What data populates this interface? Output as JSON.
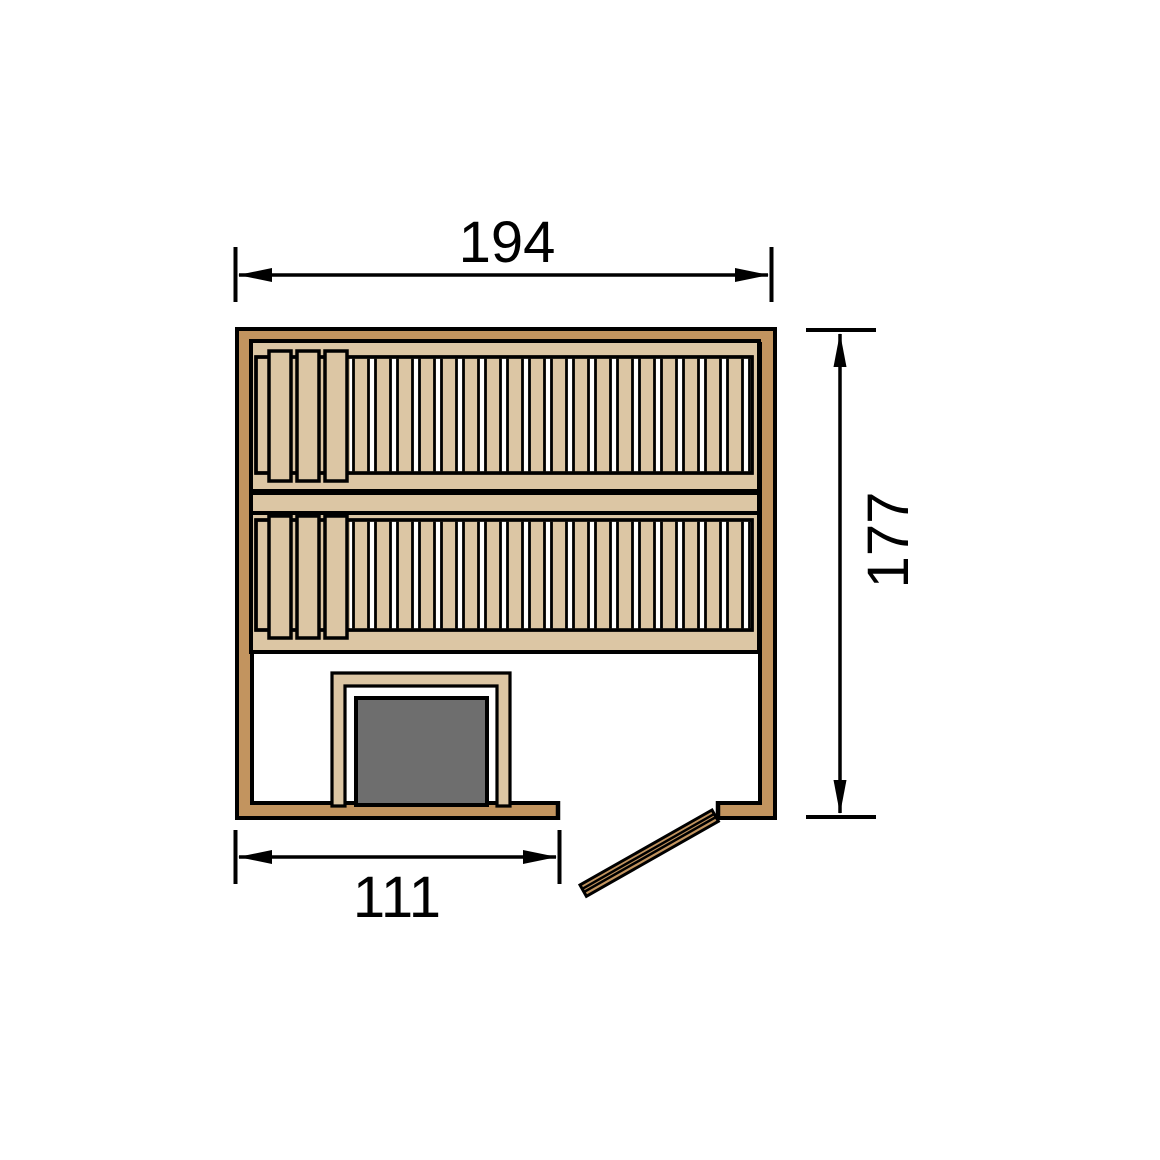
{
  "title": "Sauna floor plan technical drawing",
  "dimensions": {
    "top": "194",
    "right": "177",
    "bottom": "111"
  },
  "elements": [
    "outer wood walls",
    "upper slatted bench with three backrest boards",
    "bench front strip",
    "lower slatted bench with three backrest boards",
    "heater with wood guard frame",
    "door opening with open door leaf"
  ],
  "colors": {
    "wall_wood": "#c2945f",
    "bench_wood": "#dcc6a4",
    "slat_gap": "#ffffff",
    "heater_gray": "#6e6e6e",
    "outline": "#000000",
    "background": "#ffffff"
  }
}
